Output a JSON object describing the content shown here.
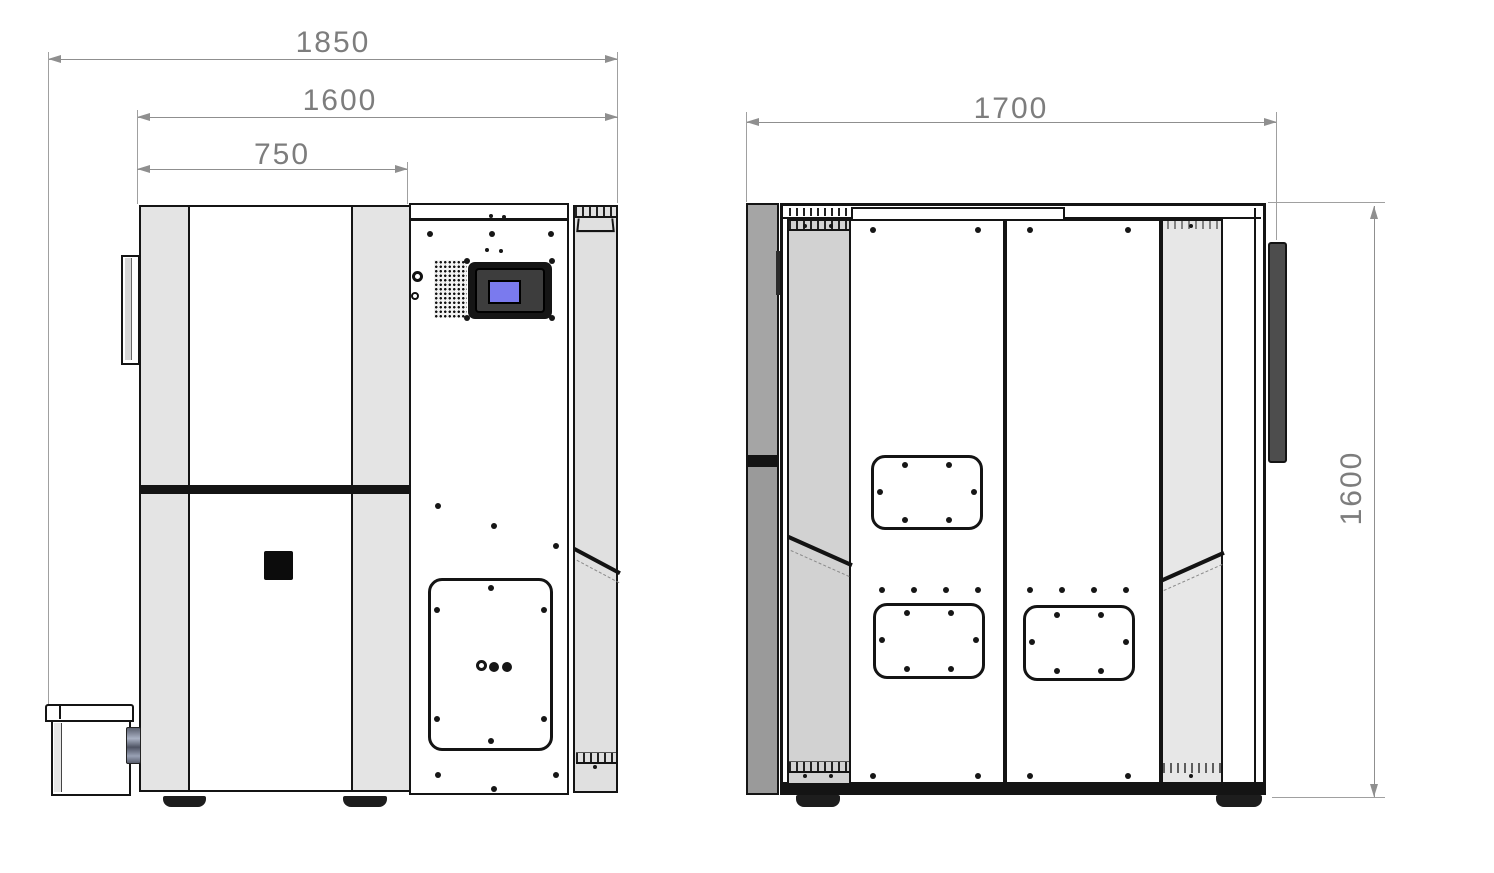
{
  "drawing": {
    "type": "technical-drawing",
    "front_view": {
      "label": "front-view",
      "dims": {
        "overall_width": "1850",
        "body_width": "1600",
        "door_width": "750"
      }
    },
    "side_view": {
      "label": "side-view",
      "dims": {
        "depth": "1700",
        "height": "1600"
      }
    },
    "colors": {
      "line": "#141414",
      "dimension_gray": "#7d7d7d",
      "panel_light_gray": "#e4e4e4",
      "column_gray": "#d2d2d2",
      "dark_strip_gray": "#a5a5a5",
      "handle_dark": "#4d4d4d",
      "screen_blue": "#7a7aee"
    }
  }
}
